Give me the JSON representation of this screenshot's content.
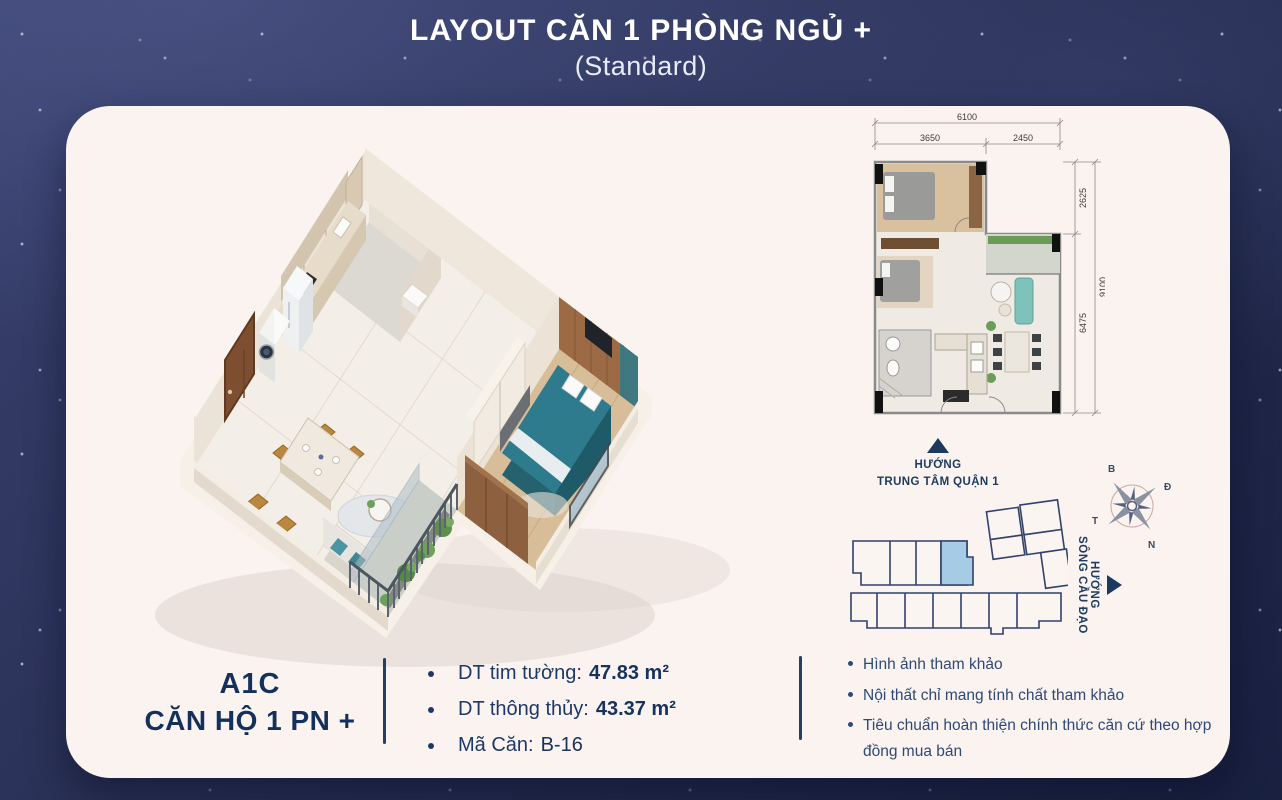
{
  "title": {
    "main": "LAYOUT CĂN 1 PHÒNG NGỦ +",
    "sub": "(Standard)"
  },
  "floor_plan": {
    "total_width": "6100",
    "bed_width": "3650",
    "void_width": "2450",
    "bed_depth": "2625",
    "living_depth": "6475",
    "total_depth": "9100"
  },
  "directions": {
    "city": {
      "line1": "HƯỚNG",
      "line2": "TRUNG TÂM QUẬN 1",
      "icon": "up-triangle"
    },
    "river": {
      "line1": "HƯỚNG",
      "line2": "SÔNG CẦU ĐẠO",
      "icon": "right-triangle"
    }
  },
  "compass": {
    "north": "B",
    "east": "Đ",
    "west": "T",
    "south": "N"
  },
  "unit_info": {
    "code": "A1C",
    "name": "CĂN HỘ 1 PN +",
    "specs": [
      {
        "label": "DT tim tường:",
        "value": "47.83 m²"
      },
      {
        "label": "DT thông thủy:",
        "value": "43.37 m²"
      },
      {
        "label": "Mã Căn:",
        "value": "B-16"
      }
    ]
  },
  "notes": [
    "Hình ảnh tham khảo",
    "Nội thất chỉ mang tính chất tham khảo",
    "Tiêu chuẩn hoàn thiện chính thức căn cứ theo hợp đồng mua bán"
  ],
  "colors": {
    "background_navy": "#272e52",
    "card": "#fbf3f0",
    "accent_navy": "#16325e",
    "keyplan_highlight": "#a6cbe4",
    "bed_teal": "#2d7b8d"
  }
}
